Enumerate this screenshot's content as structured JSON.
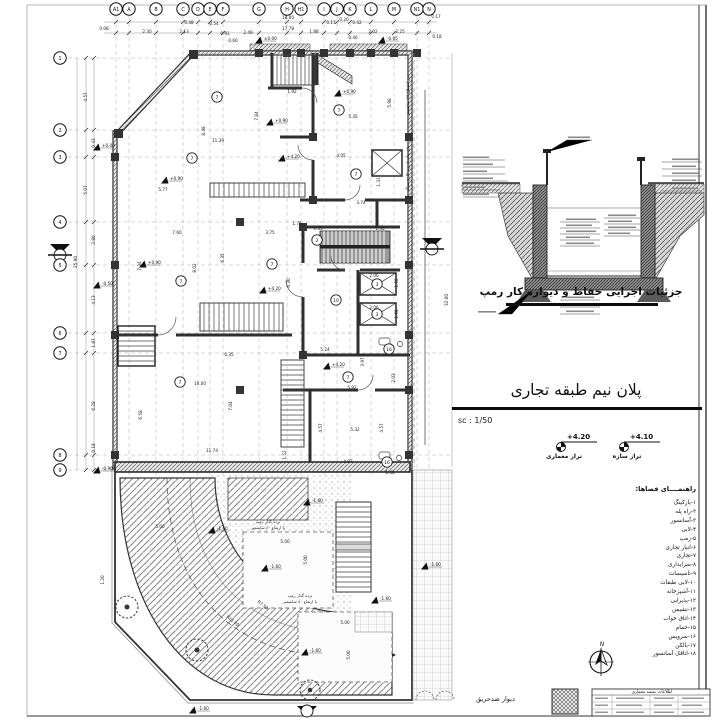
{
  "sheet": {
    "title": "پلان نیم طبقه تجاری",
    "scale_label": "sc : 1/50",
    "detail_caption": "جزئیات اجرایی حفاظ و دیواره کار رمپ",
    "firewall_label": "دیوار ضدحریق",
    "north_label": "N",
    "titleblock_header": "اطلاعات نقشه معماری",
    "line_color": "#2b2b2b",
    "hatch_color": "#666666"
  },
  "levels": [
    {
      "value": "+4.20",
      "label": "تراز معماری"
    },
    {
      "value": "+4.10",
      "label": "تراز سازه"
    }
  ],
  "legend": {
    "header": "راهنمــــای فضاها:",
    "items": [
      "۱-پارکینگ",
      "۲-راه پله",
      "۳-آسانسور",
      "۴-لابی",
      "۵-رمپ",
      "۶-انبار تجاری",
      "۷-تجاری",
      "۸-سرایداری",
      "۹-تاسیسات",
      "۱۰-لابی طبقات",
      "۱۱-آشپزخانه",
      "۱۲-پذیرایی",
      "۱۳-نشیمن",
      "۱۴-اتاق خواب",
      "۱۵-حمام",
      "۱۶-سرویس",
      "۱۷-بالکن",
      "۱۸-اتاقک آسانسور"
    ]
  },
  "grid": {
    "cols": [
      [
        "A1",
        116
      ],
      [
        "A",
        129
      ],
      [
        "B",
        156
      ],
      [
        "C",
        183
      ],
      [
        "D",
        198
      ],
      [
        "E",
        210
      ],
      [
        "F",
        223
      ],
      [
        "G",
        259
      ],
      [
        "H",
        287
      ],
      [
        "H1",
        301
      ],
      [
        "I",
        324
      ],
      [
        "J",
        337
      ],
      [
        "K",
        350
      ],
      [
        "L",
        371
      ],
      [
        "M",
        394
      ],
      [
        "N1",
        417
      ],
      [
        "N",
        429
      ]
    ],
    "rows": [
      [
        "1",
        58
      ],
      [
        "2",
        130
      ],
      [
        "3",
        157
      ],
      [
        "4",
        222
      ],
      [
        "5",
        265
      ],
      [
        "6",
        333
      ],
      [
        "7",
        353
      ],
      [
        "8",
        455
      ],
      [
        "9",
        470
      ]
    ]
  },
  "dims": [
    [
      "0.48",
      189,
      24
    ],
    [
      "0.54",
      214,
      25
    ],
    [
      "18.00",
      288,
      19
    ],
    [
      "0.17",
      331,
      24
    ],
    [
      "0.20",
      344,
      21
    ],
    [
      "0.42",
      357,
      24
    ],
    [
      "0.17",
      436,
      18
    ],
    [
      "0.08",
      104,
      30
    ],
    [
      "2.30",
      147,
      33
    ],
    [
      "2.13",
      184,
      33
    ],
    [
      "0.91",
      225,
      35
    ],
    [
      "2.49",
      248,
      34
    ],
    [
      "17.78",
      288,
      30
    ],
    [
      "1.88",
      314,
      33
    ],
    [
      "0.46",
      353,
      39
    ],
    [
      "2.02",
      373,
      33
    ],
    [
      "2.25",
      400,
      33
    ],
    [
      "0.18",
      437,
      38
    ],
    [
      "0.60",
      233,
      42
    ],
    [
      "4.57",
      87,
      97,
      -90
    ],
    [
      "0.43",
      95,
      143,
      -90
    ],
    [
      "5.07",
      87,
      190,
      -90
    ],
    [
      "2.80",
      95,
      240,
      -90
    ],
    [
      "25.90",
      77,
      262,
      -90
    ],
    [
      "4.13",
      95,
      300,
      -90
    ],
    [
      "1.87",
      95,
      343,
      -90
    ],
    [
      "6.28",
      95,
      406,
      -90
    ],
    [
      "0.18",
      95,
      448,
      -90
    ],
    [
      "32.00",
      448,
      300,
      -90
    ],
    [
      "5.98",
      391,
      103,
      -90
    ],
    [
      "1.31",
      380,
      182,
      -90
    ],
    [
      "2.03",
      395,
      378,
      -90
    ],
    [
      "1.92",
      292,
      93
    ],
    [
      "5.35",
      353,
      118
    ],
    [
      "11.39",
      218,
      142
    ],
    [
      "8.48",
      205,
      131,
      -90
    ],
    [
      "7.84",
      258,
      116,
      -90
    ],
    [
      "4.05",
      341,
      157
    ],
    [
      "5.77",
      163,
      191
    ],
    [
      "3.74",
      361,
      204
    ],
    [
      "7.60",
      177,
      234
    ],
    [
      "3.75",
      270,
      234
    ],
    [
      "1.35",
      318,
      230
    ],
    [
      "1.35",
      380,
      230
    ],
    [
      "1.75",
      297,
      225
    ],
    [
      "7.34",
      141,
      266,
      -90
    ],
    [
      "8.02",
      196,
      268,
      -90
    ],
    [
      "6.35",
      224,
      258,
      -90
    ],
    [
      "6.30",
      290,
      283,
      -90
    ],
    [
      "2.06",
      374,
      277
    ],
    [
      "1.60",
      398,
      283,
      -90
    ],
    [
      "2.06",
      374,
      309
    ],
    [
      "1.60",
      398,
      314,
      -90
    ],
    [
      "5.24",
      325,
      351
    ],
    [
      "3.97",
      364,
      362,
      -90
    ],
    [
      "6.35",
      229,
      356
    ],
    [
      "10.00",
      200,
      385
    ],
    [
      "5.92",
      352,
      389
    ],
    [
      "7.04",
      232,
      406,
      -90
    ],
    [
      "6.58",
      142,
      415,
      -90
    ],
    [
      "11.74",
      212,
      452
    ],
    [
      "5.32",
      355,
      431
    ],
    [
      "4.57",
      322,
      428,
      -90
    ],
    [
      "4.57",
      383,
      428,
      -90
    ],
    [
      "4.97",
      348,
      463
    ],
    [
      "1.52",
      286,
      455,
      -90
    ],
    [
      "1.40",
      390,
      474
    ],
    [
      "5.00",
      160,
      528
    ],
    [
      "5.00",
      285,
      543
    ],
    [
      "5.00",
      307,
      560,
      -90
    ],
    [
      "5.00",
      345,
      624
    ],
    [
      "5.00",
      350,
      655,
      -90
    ],
    [
      "1.20",
      104,
      580,
      -90
    ],
    [
      "R7.50",
      262,
      606,
      38
    ],
    [
      "R11.20",
      232,
      622,
      38
    ]
  ],
  "rooms": [
    [
      "7",
      217,
      97
    ],
    [
      "7",
      192,
      158
    ],
    [
      "7",
      339,
      110
    ],
    [
      "7",
      356,
      174
    ],
    [
      "7",
      181,
      281
    ],
    [
      "7",
      272,
      264
    ],
    [
      "7",
      180,
      382
    ],
    [
      "7",
      348,
      377
    ],
    [
      "2",
      317,
      240
    ],
    [
      "3",
      377,
      284
    ],
    [
      "3",
      377,
      314
    ],
    [
      "10",
      336,
      300
    ],
    [
      "16",
      389,
      349
    ],
    [
      "16",
      387,
      462
    ]
  ],
  "elevations": [
    [
      "±0.00",
      262,
      40
    ],
    [
      "-0.05",
      385,
      40
    ],
    [
      "+0.00",
      100,
      147
    ],
    [
      "-0.50",
      100,
      285
    ],
    [
      "-0.90",
      100,
      470
    ],
    [
      "+0.90",
      273,
      122
    ],
    [
      "+0.90",
      341,
      93
    ],
    [
      "+0.90",
      168,
      180
    ],
    [
      "+0.90",
      146,
      264
    ],
    [
      "+4.20",
      285,
      158
    ],
    [
      "+4.20",
      266,
      290
    ],
    [
      "+4.20",
      330,
      366
    ],
    [
      "-1.60",
      310,
      502
    ],
    [
      "-1.60",
      215,
      530
    ],
    [
      "-1.60",
      268,
      568
    ],
    [
      "-1.60",
      378,
      600
    ],
    [
      "-1.60",
      428,
      566
    ],
    [
      "-1.60",
      308,
      652
    ],
    [
      "-1.60",
      196,
      710
    ]
  ],
  "notes": [
    [
      "درز انقطاع ۷۷ سانتیمتر",
      409,
      95,
      -90,
      4.2
    ],
    [
      "جان پناه با رویه کاری سنگ",
      409,
      168,
      -90,
      4.2
    ],
    [
      "نرده گذار رمپ",
      268,
      523,
      0,
      4
    ],
    [
      "با ارتفاع ۸۰ سانتیمتر",
      268,
      529,
      0,
      4
    ],
    [
      "نرده گذار رمپ",
      300,
      597,
      0,
      4
    ],
    [
      "با ارتفاع ۸۰ سانتیمتر",
      300,
      603,
      0,
      4
    ]
  ]
}
